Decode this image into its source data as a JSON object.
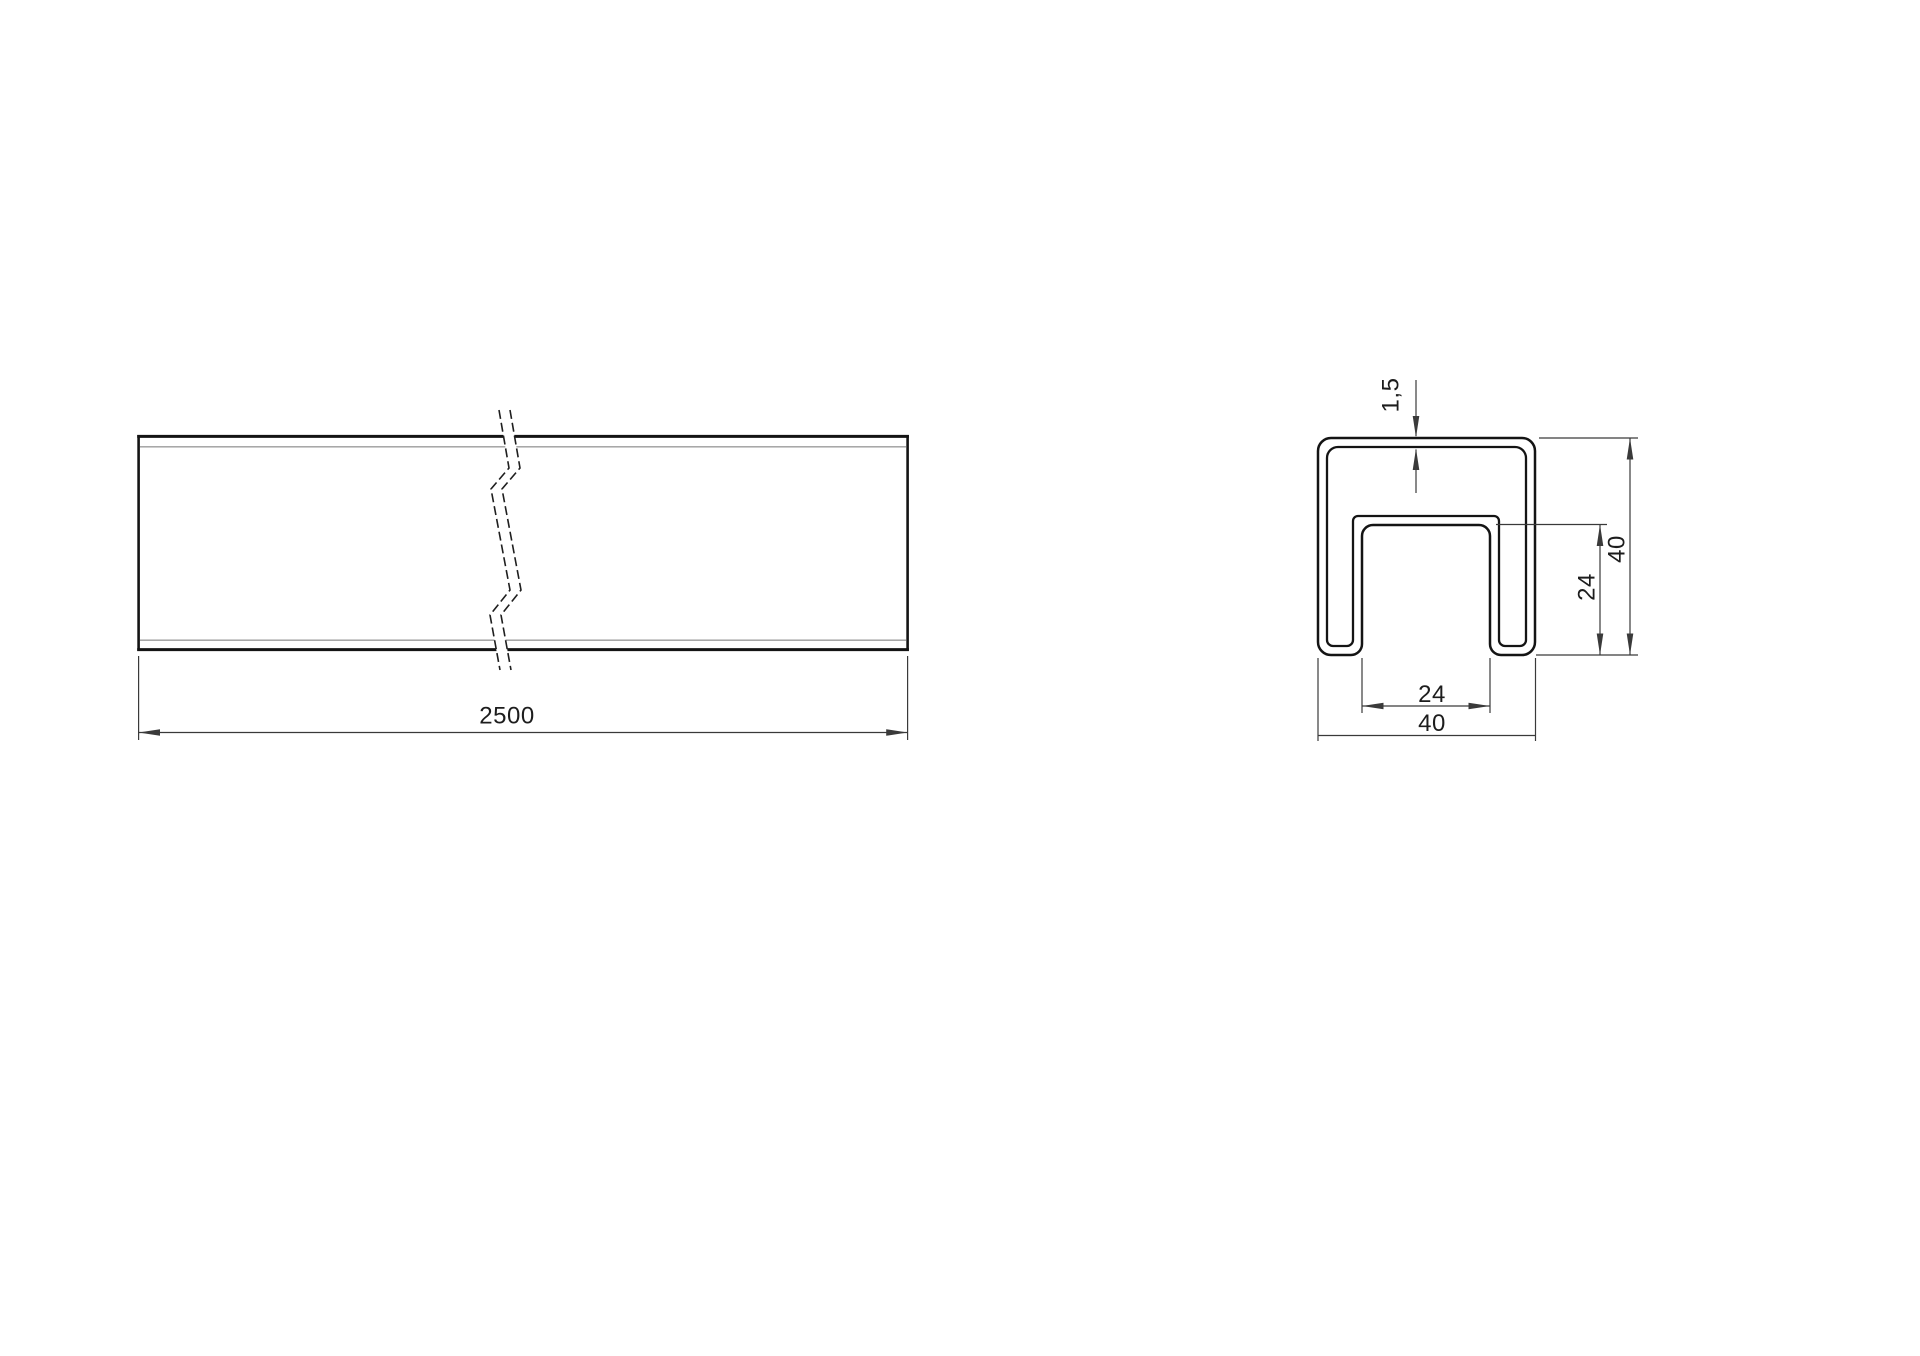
{
  "page": {
    "background": "#ffffff"
  },
  "drawing": {
    "colors": {
      "outline": "#141414",
      "dimension": "#3a3a3a",
      "edge_hint": "#9b9b9b",
      "break_line": "#1f1f1f"
    },
    "side_view": {
      "length": "2500"
    },
    "section_view": {
      "wall_thickness": "1,5",
      "outer_height": "40",
      "slot_depth": "24",
      "slot_width": "24",
      "outer_width": "40"
    }
  }
}
